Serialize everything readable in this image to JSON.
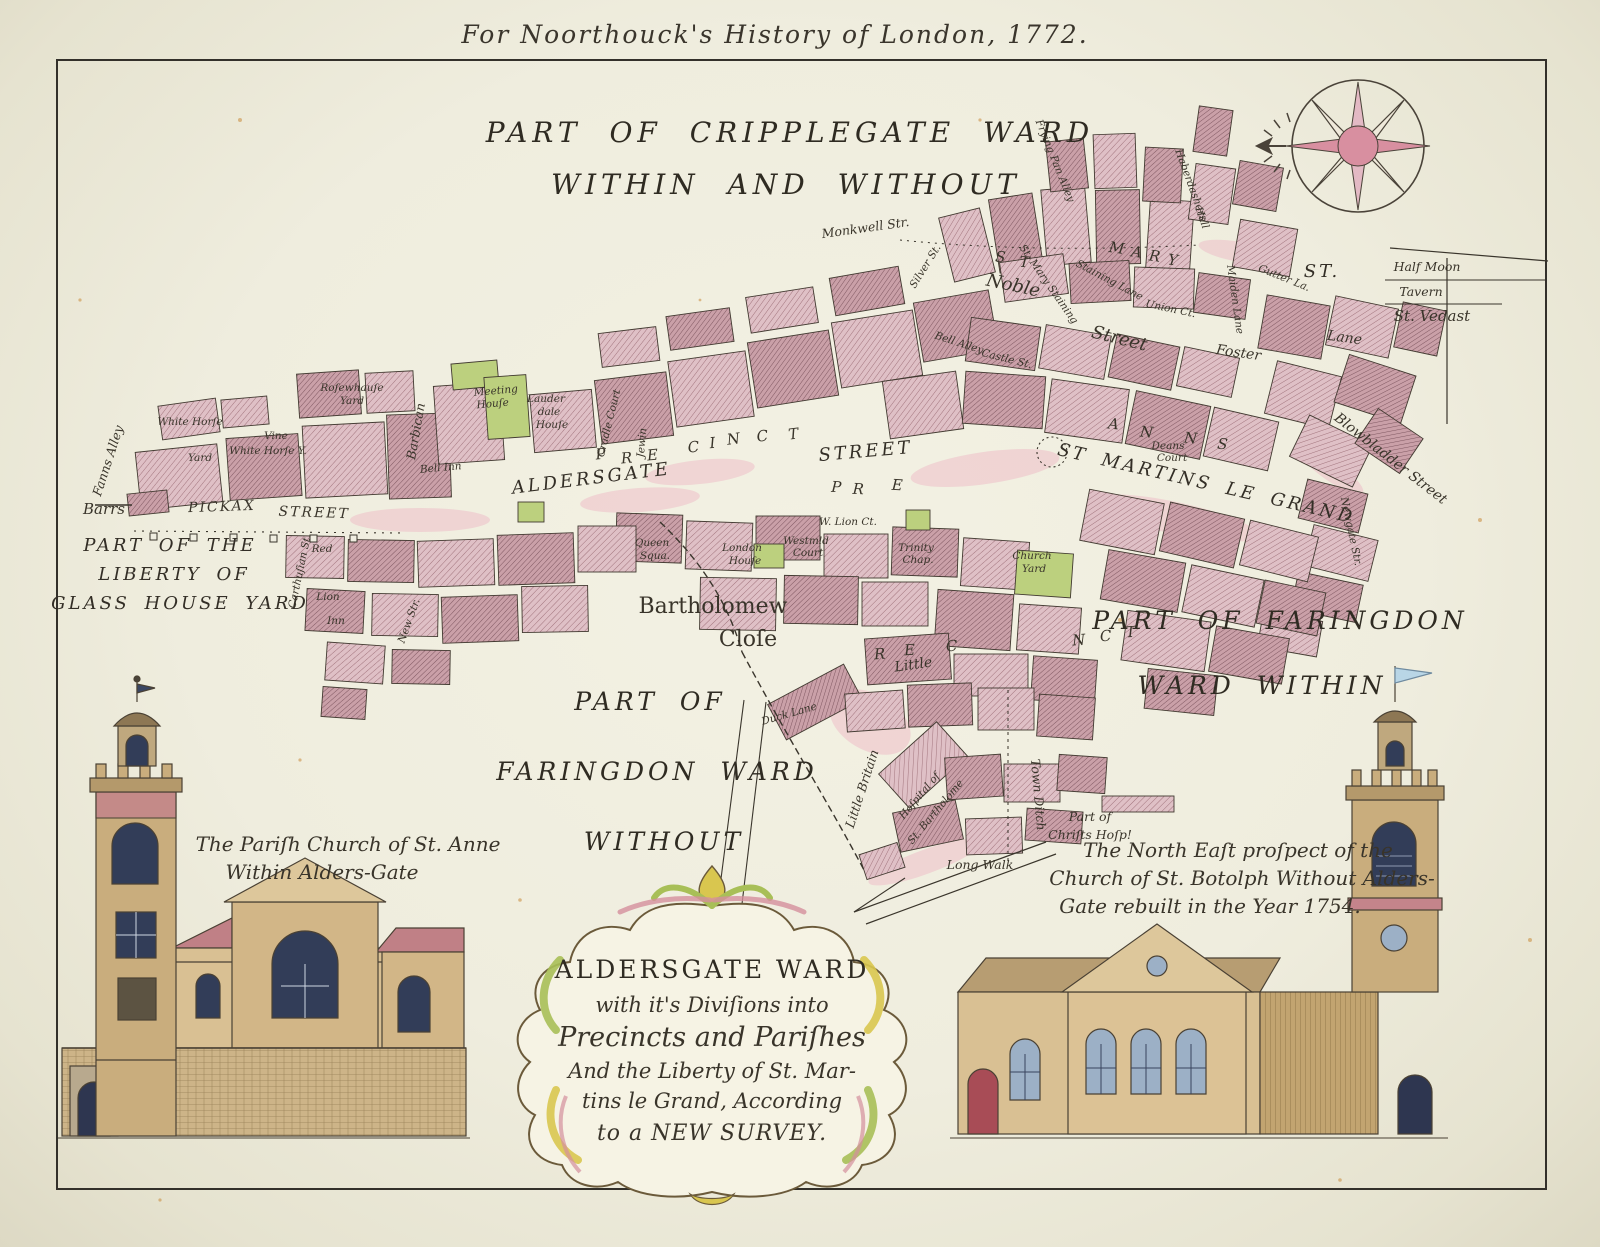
{
  "imprint": "For Noorthouck's History of London, 1772.",
  "palette": {
    "paper": "#f0eee0",
    "ink": "#39342a",
    "building_light": "#dfc0c6",
    "building_dark": "#caa0a8",
    "green_plot": "#bcd07e",
    "compass_pink": "#d88fa0",
    "church_tan": "#d9c093",
    "roof_pink": "#c4848b",
    "window_blue": "#9cb0c6",
    "flag_blue": "#b9d6e6"
  },
  "map": {
    "labels": [
      {
        "t": "PART OF CRIPPLEGATE WARD",
        "x": 790,
        "y": 142,
        "k": "caps-xl"
      },
      {
        "t": "WITHIN AND WITHOUT",
        "x": 786,
        "y": 194,
        "k": "caps-xl"
      },
      {
        "t": "PART OF THE",
        "x": 170,
        "y": 551,
        "k": "caps-md"
      },
      {
        "t": "LIBERTY OF",
        "x": 174,
        "y": 580,
        "k": "caps-md"
      },
      {
        "t": "GLASS HOUSE YARD",
        "x": 180,
        "y": 609,
        "k": "caps-md"
      },
      {
        "t": "PART OF FARINGDON",
        "x": 1280,
        "y": 629,
        "k": "caps-lg"
      },
      {
        "t": "WARD WITHIN",
        "x": 1262,
        "y": 694,
        "k": "caps-lg"
      },
      {
        "t": "PART OF",
        "x": 650,
        "y": 710,
        "k": "caps-lg"
      },
      {
        "t": "FARINGDON WARD",
        "x": 657,
        "y": 780,
        "k": "caps-lg"
      },
      {
        "t": "WITHOUT",
        "x": 664,
        "y": 850,
        "k": "caps-lg"
      },
      {
        "t": "Bartholomew",
        "x": 713,
        "y": 613,
        "k": "serif-lg"
      },
      {
        "t": "Cloſe",
        "x": 748,
        "y": 646,
        "k": "serif-lg"
      },
      {
        "t": "Little",
        "x": 914,
        "y": 669,
        "k": "serif-sm",
        "r": -8
      },
      {
        "t": "Barrs",
        "x": 104,
        "y": 514,
        "k": "it-md"
      },
      {
        "t": "PICKAX",
        "x": 222,
        "y": 511,
        "k": "caps-sm",
        "r": -2
      },
      {
        "t": "STREET",
        "x": 314,
        "y": 517,
        "k": "caps-sm",
        "r": 2
      },
      {
        "t": "ALDERSGATE",
        "x": 592,
        "y": 484,
        "k": "caps-md",
        "r": -7
      },
      {
        "t": "STREET",
        "x": 866,
        "y": 457,
        "k": "caps-md",
        "r": -5
      },
      {
        "t": "ST MARTINS LE GRAND",
        "x": 1205,
        "y": 489,
        "k": "caps-md",
        "r": 13
      },
      {
        "t": "Noble",
        "x": 1012,
        "y": 291,
        "k": "serif-md",
        "r": 12
      },
      {
        "t": "Street",
        "x": 1118,
        "y": 344,
        "k": "serif-md",
        "r": 14
      },
      {
        "t": "Foster",
        "x": 1238,
        "y": 357,
        "k": "serif-sm",
        "r": 8
      },
      {
        "t": "Lane",
        "x": 1344,
        "y": 342,
        "k": "serif-sm",
        "r": 8
      },
      {
        "t": "Half Moon",
        "x": 1427,
        "y": 271,
        "k": "it-sm"
      },
      {
        "t": "Tavern",
        "x": 1421,
        "y": 296,
        "k": "it-sm"
      },
      {
        "t": "St. Vedast",
        "x": 1432,
        "y": 321,
        "k": "it-md"
      },
      {
        "t": "Blowbladder Street",
        "x": 1388,
        "y": 462,
        "k": "serif-sm",
        "r": 38
      },
      {
        "t": "Newgate Str.",
        "x": 1348,
        "y": 532,
        "k": "it-xs",
        "r": 78
      },
      {
        "t": "Monkwell Str.",
        "x": 866,
        "y": 232,
        "k": "it-sm",
        "r": -8
      },
      {
        "t": "Frying Pan Alley",
        "x": 1052,
        "y": 162,
        "k": "it-xs",
        "r": 68
      },
      {
        "t": "Haberdashers",
        "x": 1188,
        "y": 186,
        "k": "it-xs",
        "r": 70
      },
      {
        "t": "Hall",
        "x": 1199,
        "y": 219,
        "k": "it-xs",
        "r": 70
      },
      {
        "t": "Maiden Lane",
        "x": 1232,
        "y": 300,
        "k": "it-xs",
        "r": 82
      },
      {
        "t": "Gutter La.",
        "x": 1283,
        "y": 281,
        "k": "it-xs",
        "r": 22
      },
      {
        "t": "Staining Lane",
        "x": 1108,
        "y": 283,
        "k": "it-xs",
        "r": 28
      },
      {
        "t": "St. Mary Staining",
        "x": 1046,
        "y": 286,
        "k": "it-xs",
        "r": 55
      },
      {
        "t": "Silver St.",
        "x": 928,
        "y": 268,
        "k": "it-xs",
        "r": -58
      },
      {
        "t": "Bell Alley",
        "x": 958,
        "y": 346,
        "k": "it-xs",
        "r": 18
      },
      {
        "t": "Castle St.",
        "x": 1006,
        "y": 362,
        "k": "it-xs",
        "r": 14
      },
      {
        "t": "Union Ct.",
        "x": 1170,
        "y": 312,
        "k": "it-xs",
        "r": 12
      },
      {
        "t": "Meeting",
        "x": 496,
        "y": 394,
        "k": "it-xs",
        "r": -5
      },
      {
        "t": "Houſe",
        "x": 493,
        "y": 407,
        "k": "it-xs",
        "r": -5
      },
      {
        "t": "Lauder",
        "x": 546,
        "y": 402,
        "k": "it-xs"
      },
      {
        "t": "dale",
        "x": 549,
        "y": 415,
        "k": "it-xs"
      },
      {
        "t": "Houſe",
        "x": 552,
        "y": 428,
        "k": "it-xs"
      },
      {
        "t": "Barbican",
        "x": 420,
        "y": 432,
        "k": "it-sm",
        "r": -80
      },
      {
        "t": "Bell Inn",
        "x": 441,
        "y": 471,
        "k": "it-xs",
        "r": -5
      },
      {
        "t": "Cradle Court",
        "x": 612,
        "y": 424,
        "k": "it-xs",
        "r": -76
      },
      {
        "t": "Jewin",
        "x": 645,
        "y": 443,
        "k": "it-xs",
        "r": -85
      },
      {
        "t": "Roſewhauſe",
        "x": 352,
        "y": 391,
        "k": "it-xs"
      },
      {
        "t": "Yard",
        "x": 352,
        "y": 404,
        "k": "it-xs"
      },
      {
        "t": "White Horſe",
        "x": 190,
        "y": 425,
        "k": "it-xs"
      },
      {
        "t": "Vine",
        "x": 276,
        "y": 439,
        "k": "it-xs"
      },
      {
        "t": "Yard",
        "x": 200,
        "y": 461,
        "k": "it-xs"
      },
      {
        "t": "White Horſe Y.",
        "x": 268,
        "y": 454,
        "k": "it-xs"
      },
      {
        "t": "Fanns Alley",
        "x": 112,
        "y": 462,
        "k": "it-sm",
        "r": -72
      },
      {
        "t": "Carthuſian St.",
        "x": 303,
        "y": 572,
        "k": "it-xs",
        "r": -78
      },
      {
        "t": "Red",
        "x": 322,
        "y": 552,
        "k": "it-xs"
      },
      {
        "t": "Lion",
        "x": 328,
        "y": 600,
        "k": "it-xs"
      },
      {
        "t": "Inn",
        "x": 336,
        "y": 624,
        "k": "it-xs"
      },
      {
        "t": "New Str.",
        "x": 412,
        "y": 622,
        "k": "it-xs",
        "r": -70
      },
      {
        "t": "Queen",
        "x": 652,
        "y": 546,
        "k": "it-xs"
      },
      {
        "t": "Squa.",
        "x": 655,
        "y": 559,
        "k": "it-xs"
      },
      {
        "t": "London",
        "x": 742,
        "y": 551,
        "k": "it-xs"
      },
      {
        "t": "Houſe",
        "x": 745,
        "y": 564,
        "k": "it-xs"
      },
      {
        "t": "W. Lion Ct.",
        "x": 848,
        "y": 525,
        "k": "it-xs"
      },
      {
        "t": "Westmld",
        "x": 806,
        "y": 544,
        "k": "it-xs"
      },
      {
        "t": "Court",
        "x": 808,
        "y": 556,
        "k": "it-xs"
      },
      {
        "t": "Trinity",
        "x": 916,
        "y": 551,
        "k": "it-xs"
      },
      {
        "t": "Chap.",
        "x": 918,
        "y": 563,
        "k": "it-xs"
      },
      {
        "t": "Church",
        "x": 1032,
        "y": 559,
        "k": "it-xs"
      },
      {
        "t": "Yard",
        "x": 1034,
        "y": 572,
        "k": "it-xs"
      },
      {
        "t": "Deans",
        "x": 1168,
        "y": 449,
        "k": "it-xs"
      },
      {
        "t": "Court",
        "x": 1172,
        "y": 461,
        "k": "it-xs"
      },
      {
        "t": "ST.",
        "x": 1322,
        "y": 277,
        "k": "caps-md"
      },
      {
        "t": "Duck Lane",
        "x": 790,
        "y": 717,
        "k": "it-xs",
        "r": -16
      },
      {
        "t": "Little Britain",
        "x": 866,
        "y": 790,
        "k": "it-sm",
        "r": -72
      },
      {
        "t": "Hoſpital of",
        "x": 922,
        "y": 798,
        "k": "it-xs",
        "r": -50
      },
      {
        "t": "St. Bartholome",
        "x": 938,
        "y": 814,
        "k": "it-xs",
        "r": -50
      },
      {
        "t": "Town Ditch",
        "x": 1034,
        "y": 795,
        "k": "it-sm",
        "r": 85
      },
      {
        "t": "Part of",
        "x": 1090,
        "y": 821,
        "k": "it-sm"
      },
      {
        "t": "Chriſts Hoſp!",
        "x": 1090,
        "y": 839,
        "k": "it-sm"
      },
      {
        "t": "Long Walk",
        "x": 980,
        "y": 869,
        "k": "it-sm"
      },
      {
        "t": "P",
        "x": 601,
        "y": 459,
        "k": "letter",
        "r": -5
      },
      {
        "t": "R",
        "x": 627,
        "y": 463,
        "k": "letter",
        "r": -5
      },
      {
        "t": "E",
        "x": 653,
        "y": 460,
        "k": "letter",
        "r": -5
      },
      {
        "t": "C",
        "x": 694,
        "y": 452,
        "k": "letter",
        "r": -6
      },
      {
        "t": "I",
        "x": 713,
        "y": 448,
        "k": "letter",
        "r": -6
      },
      {
        "t": "N",
        "x": 734,
        "y": 444,
        "k": "letter",
        "r": -7
      },
      {
        "t": "C",
        "x": 763,
        "y": 441,
        "k": "letter",
        "r": -7
      },
      {
        "t": "T",
        "x": 794,
        "y": 439,
        "k": "letter",
        "r": -7
      },
      {
        "t": "P",
        "x": 836,
        "y": 492,
        "k": "letter",
        "r": 3
      },
      {
        "t": "R",
        "x": 858,
        "y": 494,
        "k": "letter",
        "r": 3
      },
      {
        "t": "E",
        "x": 897,
        "y": 490,
        "k": "letter",
        "r": 3
      },
      {
        "t": "R",
        "x": 880,
        "y": 659,
        "k": "letter",
        "r": -4
      },
      {
        "t": "E",
        "x": 910,
        "y": 655,
        "k": "letter",
        "r": -4
      },
      {
        "t": "C",
        "x": 952,
        "y": 651,
        "k": "letter",
        "r": -4
      },
      {
        "t": "N",
        "x": 1079,
        "y": 645,
        "k": "letter",
        "r": -4
      },
      {
        "t": "C",
        "x": 1106,
        "y": 641,
        "k": "letter",
        "r": -4
      },
      {
        "t": "T",
        "x": 1131,
        "y": 637,
        "k": "letter",
        "r": -4
      },
      {
        "t": "M",
        "x": 1116,
        "y": 253,
        "k": "letter",
        "r": 8
      },
      {
        "t": "A",
        "x": 1136,
        "y": 257,
        "k": "letter",
        "r": 8
      },
      {
        "t": "R",
        "x": 1154,
        "y": 261,
        "k": "letter",
        "r": 8
      },
      {
        "t": "Y",
        "x": 1172,
        "y": 265,
        "k": "letter",
        "r": 8
      },
      {
        "t": "S",
        "x": 1000,
        "y": 262,
        "k": "letter",
        "r": 5
      },
      {
        "t": "T",
        "x": 1024,
        "y": 267,
        "k": "letter",
        "r": 5
      },
      {
        "t": "A",
        "x": 1113,
        "y": 429,
        "k": "letter",
        "r": 6
      },
      {
        "t": "N",
        "x": 1146,
        "y": 437,
        "k": "letter",
        "r": 6
      },
      {
        "t": "N",
        "x": 1190,
        "y": 443,
        "k": "letter",
        "r": 6
      },
      {
        "t": "S",
        "x": 1222,
        "y": 449,
        "k": "letter",
        "r": 6
      }
    ]
  },
  "cartouche": {
    "lines": [
      {
        "t": "ALDERSGATE WARD",
        "x": 712,
        "y": 978,
        "k": "cart-title"
      },
      {
        "t": "with it's Diviſions into",
        "x": 712,
        "y": 1012,
        "k": "cart-script"
      },
      {
        "t": "Precincts and Pariſhes",
        "x": 712,
        "y": 1046,
        "k": "cart-serif"
      },
      {
        "t": "And the Liberty of St. Mar-",
        "x": 712,
        "y": 1078,
        "k": "cart-script"
      },
      {
        "t": "tins le Grand, According",
        "x": 712,
        "y": 1108,
        "k": "cart-script"
      },
      {
        "t": "to a NEW SURVEY.",
        "x": 712,
        "y": 1140,
        "k": "cart-last"
      }
    ]
  },
  "captions": {
    "left": [
      {
        "t": "The Pariſh Church of St. Anne",
        "x": 348,
        "y": 851,
        "k": "it-lg"
      },
      {
        "t": "Within Alders-Gate",
        "x": 322,
        "y": 879,
        "k": "it-lg"
      }
    ],
    "right": [
      {
        "t": "The North Eaſt proſpect of the",
        "x": 1238,
        "y": 857,
        "k": "it-lg"
      },
      {
        "t": "Church of St. Botolph Without Alders-",
        "x": 1242,
        "y": 885,
        "k": "it-lg"
      },
      {
        "t": "Gate rebuilt in the Year 1754.",
        "x": 1210,
        "y": 913,
        "k": "it-lg"
      }
    ]
  },
  "compass": {
    "icon": "compass-rose-icon",
    "points": 8
  }
}
